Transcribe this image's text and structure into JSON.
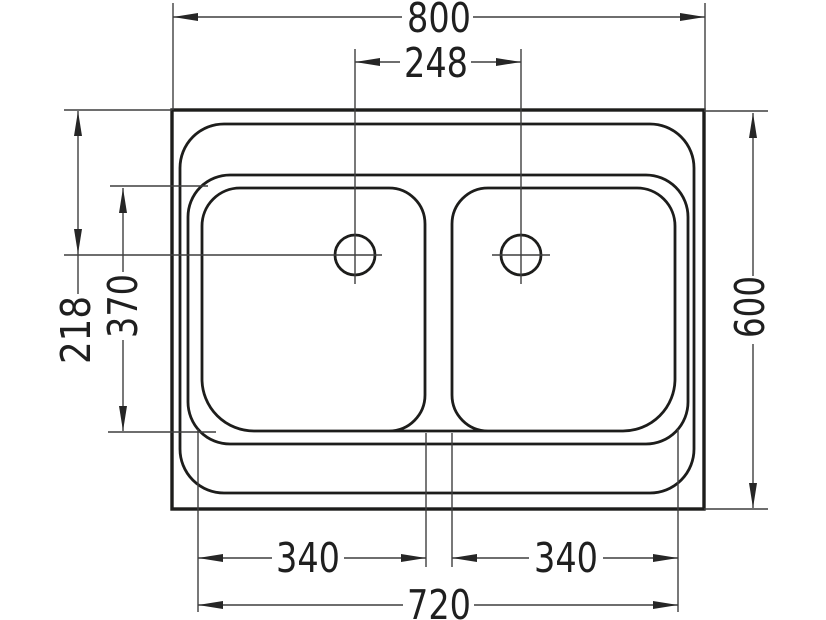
{
  "drawing": {
    "kind": "technical-dimension-drawing",
    "subject": "double-bowl sink, top view",
    "background_color": "#ffffff",
    "line_color": "#1d1d1b",
    "dimension_line_color": "#3f3f3f",
    "dims": {
      "overall_width": "800",
      "hole_spacing": "248",
      "edge_to_hole_center": "218",
      "bowl_depth": "370",
      "overall_depth": "600",
      "left_bowl_width": "340",
      "right_bowl_width": "340",
      "bowls_outer_span": "720"
    }
  }
}
